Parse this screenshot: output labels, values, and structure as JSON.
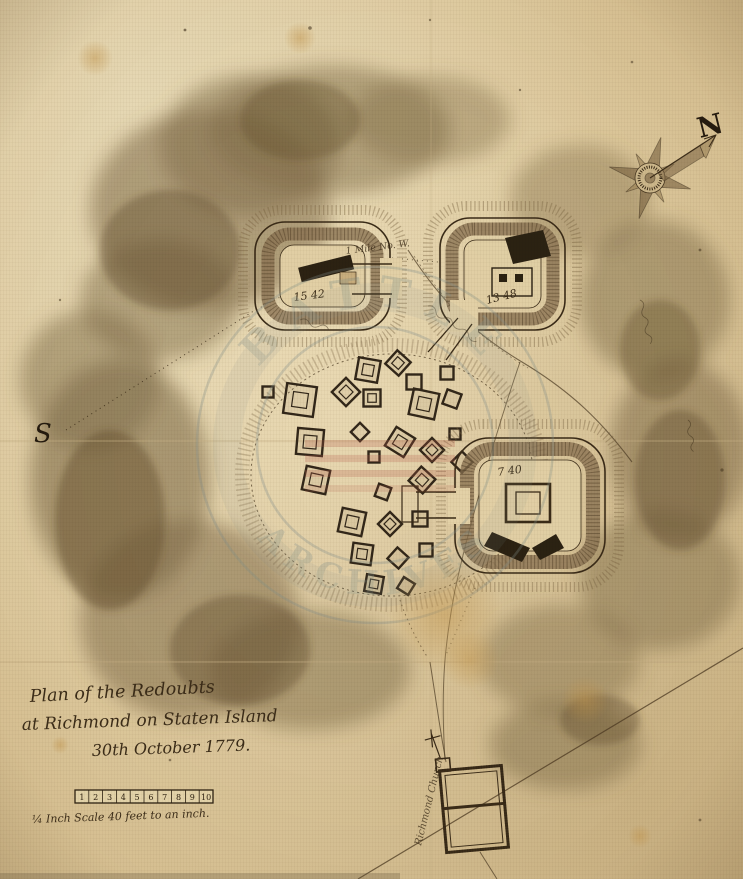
{
  "map": {
    "compass": {
      "north_label": "N"
    },
    "south_label": "S",
    "title_block": {
      "line1": "Plan of the Redoubts",
      "line2": "at Richmond on Staten Island",
      "line3": "30th October 1779."
    },
    "scale_bar": {
      "caption": "¼ Inch Scale 40 feet to an inch.",
      "ticks": [
        "1",
        "2",
        "3",
        "4",
        "5",
        "6",
        "7",
        "8",
        "9",
        "10"
      ]
    },
    "redoubt_labels": {
      "northwest": "15 42",
      "northeast": "13 48",
      "southeast": "7 40"
    },
    "annotations": {
      "distance_note": "1 Mile No. W.",
      "church_label": "Richmond Church"
    },
    "watermark": {
      "arc_top": "BATTLE",
      "arc_bottom": "ARCHIVES"
    },
    "colors": {
      "paper": "#e8d7ad",
      "ink": "#3b2c18",
      "wash": "#8a7251",
      "stamp": "#8e9a93",
      "stamp_red": "#b85c4c"
    }
  }
}
